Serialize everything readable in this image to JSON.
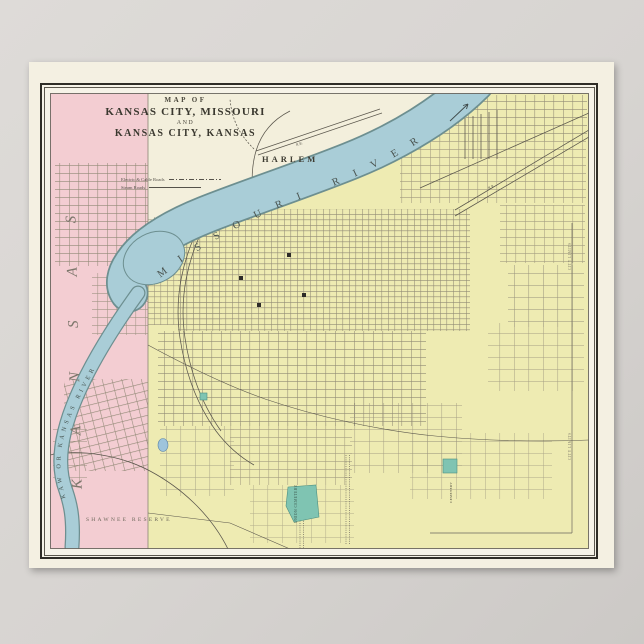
{
  "poster": {
    "title": {
      "prefix": "MAP OF",
      "city1": "KANSAS CITY, MISSOURI",
      "conjunction": "AND",
      "city2": "KANSAS CITY, KANSAS"
    },
    "legend": {
      "electric_label": "Electric & Cable Roads",
      "steam_label": "Steam Roads"
    },
    "map_labels": {
      "harlem": "HARLEM",
      "missouri_river": "MISSOURI RIVER",
      "kaw_river": "KAW OR KANSAS RIVER",
      "state_kansas": "KANSAS",
      "shawnee_reserve": "SHAWNEE RESERVE",
      "union_cemetery": "UNION CEMETERY",
      "cemetery_small": "CEMETERY",
      "city_limits_east": "CITY LIMITS",
      "city_limits_south": "CITY LIMITS",
      "railroad_1": "R.R.",
      "railroad_2": "R.R."
    },
    "colors": {
      "background_gray": "#d7d4d1",
      "paper_cream": "#f4f0e2",
      "frame_black": "#2f2d27",
      "kansas_pink": "#f3cdd2",
      "missouri_yellow": "#eeebb2",
      "north_cream": "#f3efdc",
      "river_blue": "#a9cdd7",
      "river_edge": "#6d8f90",
      "street_line": "#8d8672",
      "park_green": "#7fc4b2",
      "pond_blue": "#9ec4dc"
    }
  }
}
